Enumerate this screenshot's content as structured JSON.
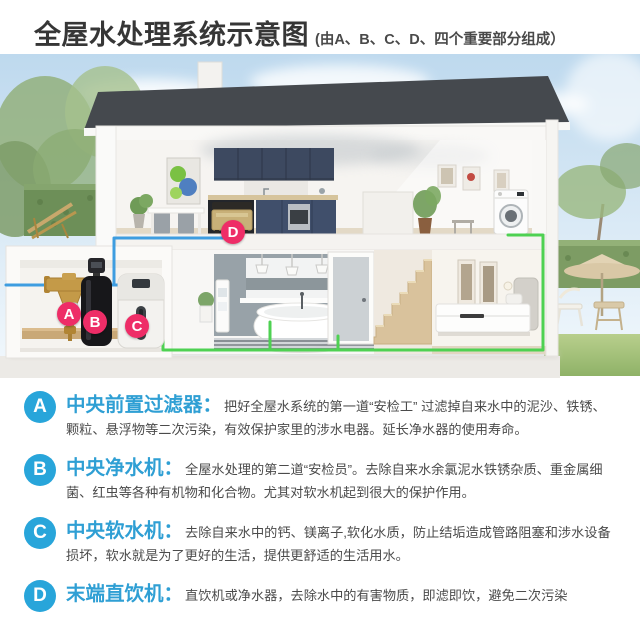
{
  "title": {
    "main": "全屋水处理系统示意图",
    "sub": "(由A、B、C、D、四个重要部分组成）"
  },
  "diagram": {
    "pins": [
      {
        "id": "A"
      },
      {
        "id": "B"
      },
      {
        "id": "C"
      },
      {
        "id": "D"
      }
    ]
  },
  "sections": [
    {
      "id": "A",
      "heading": "中央前置过滤器：",
      "body": "把好全屋水系统的第一道“安检工” 过滤掉自来水中的泥沙、铁锈、颗粒、悬浮物等二次污染，有效保护家里的涉水电器。延长净水器的使用寿命。"
    },
    {
      "id": "B",
      "heading": "中央净水机：",
      "body": "全屋水处理的第二道“安检员”。去除自来水余氯泥水铁锈杂质、重金属细菌、红虫等各种有机物和化合物。尤其对软水机起到很大的保护作用。"
    },
    {
      "id": "C",
      "heading": "中央软水机：",
      "body": "去除自来水中的钙、镁离子,软化水质，防止结垢造成管路阻塞和涉水设备损坏，软水就是为了更好的生活，提供更舒适的生活用水。"
    },
    {
      "id": "D",
      "heading": "末端直饮机：",
      "body": "直饮机或净水器，去除水中的有害物质，即滤即饮，避免二次污染"
    }
  ],
  "colors": {
    "badge_blue": "#28a5da",
    "pin_pink": "#ee2d67",
    "pipe_blue": "#3e9de0",
    "pipe_green": "#4ed152"
  }
}
